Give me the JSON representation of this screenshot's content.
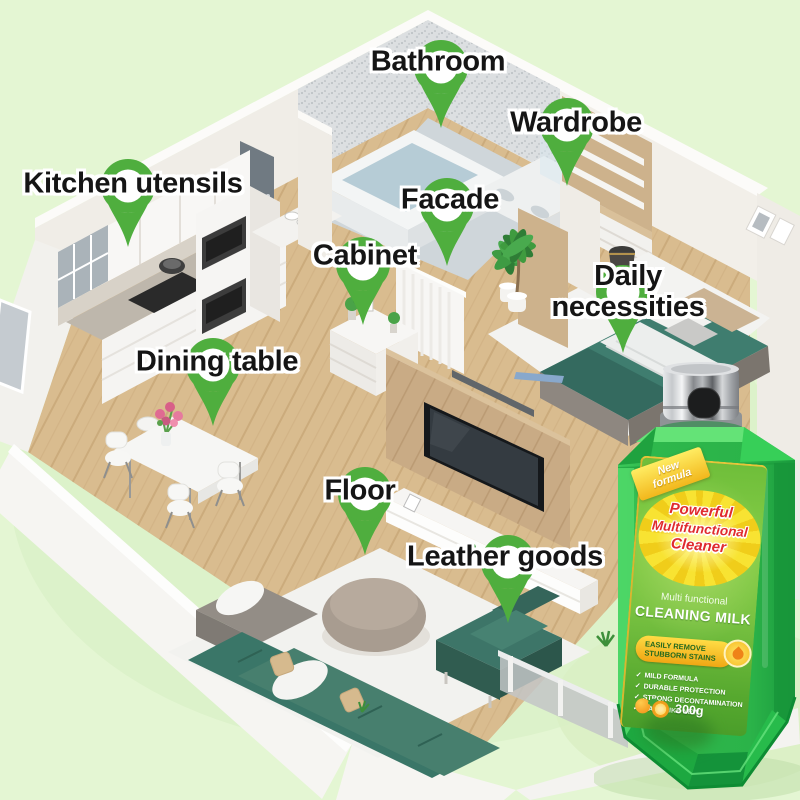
{
  "palette": {
    "background": "#e4f6d3",
    "pin_green": "#4fae3e",
    "bottle_green": "#2eb84c",
    "label_yellow": "#f6df2a",
    "headline_red": "#e02b2e",
    "sofa_teal": "#3c7a6c",
    "wood_floor": "#d9bc8f"
  },
  "pins": {
    "items": [
      {
        "id": "bathroom",
        "label": "Bathroom"
      },
      {
        "id": "wardrobe",
        "label": "Wardrobe"
      },
      {
        "id": "kitchen-utensils",
        "label": "Kitchen utensils"
      },
      {
        "id": "facade",
        "label": "Facade"
      },
      {
        "id": "cabinet",
        "label": "Cabinet"
      },
      {
        "id": "daily-necessities",
        "label": "Daily necessities"
      },
      {
        "id": "dining-table",
        "label": "Dining table"
      },
      {
        "id": "floor",
        "label": "Floor"
      },
      {
        "id": "leather-goods",
        "label": "Leather goods"
      }
    ]
  },
  "product": {
    "ribbon_text": "New formula",
    "headline_line1": "Powerful",
    "headline_line2": "Multifunctional",
    "headline_line3": "Cleaner",
    "subtitle": "Multi functional",
    "product_name": "CLEANING MILK",
    "badge_line1": "EASILY REMOVE",
    "badge_line2": "STUBBORN STAINS",
    "check_icon": "✓",
    "features": [
      "MILD FORMULA",
      "DURABLE PROTECTION",
      "STRONG DECONTAMINATION",
      "WASH LIKE NEW"
    ],
    "weight": "300g"
  }
}
